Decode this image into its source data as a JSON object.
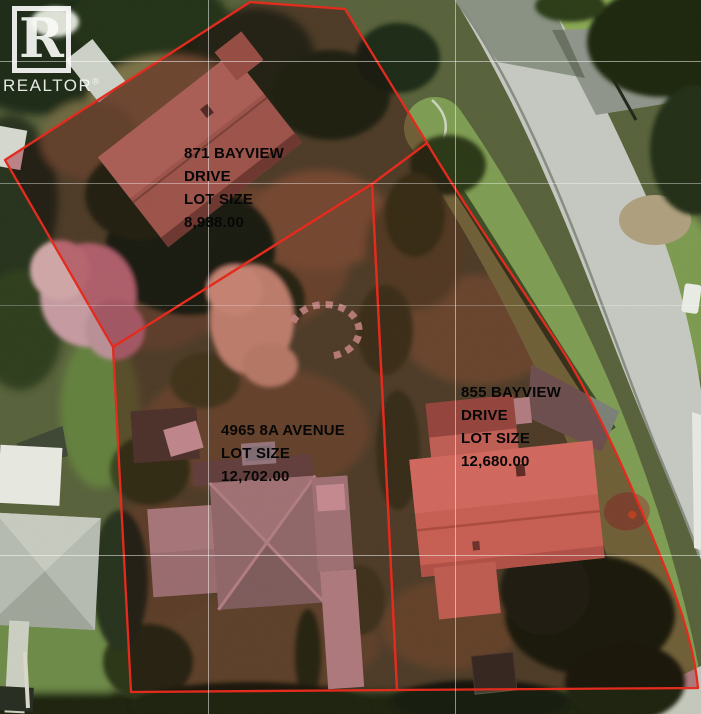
{
  "branding": {
    "logo_letter": "R",
    "logo_text": "REALTOR",
    "registered_mark": "®"
  },
  "colors": {
    "boundary_red": "#e5281b",
    "tint_red": "#c23450",
    "road_gray": "#c4c8c0",
    "label_text": "#070707"
  },
  "lots": [
    {
      "name": "871-bayview-drive",
      "address": "871 BAYVIEW DRIVE",
      "lot_size": "8,988.00",
      "label_lines": [
        "871 BAYVIEW",
        "DRIVE",
        "LOT SIZE",
        "8,988.00"
      ],
      "polygon_points": "250,2 345,9 427,143 372,184 113,347 5,160"
    },
    {
      "name": "4965-8a-avenue",
      "address": "4965 8A AVENUE",
      "lot_size": "12,702.00",
      "label_lines": [
        "4965 8A AVENUE",
        "LOT SIZE",
        "12,702.00"
      ],
      "polygon_points": "113,347 372,184 397,690 131,692"
    },
    {
      "name": "855-bayview-drive",
      "address": "855 BAYVIEW DRIVE",
      "lot_size": "12,680.00",
      "label_lines": [
        "855 BAYVIEW",
        "DRIVE",
        "LOT SIZE",
        "12,680.00"
      ],
      "boundary_path": "M427,143 C470,215 520,285 562,350 C600,410 640,505 668,575 C685,620 695,655 698,688 L397,690 L372,184 Z"
    }
  ]
}
